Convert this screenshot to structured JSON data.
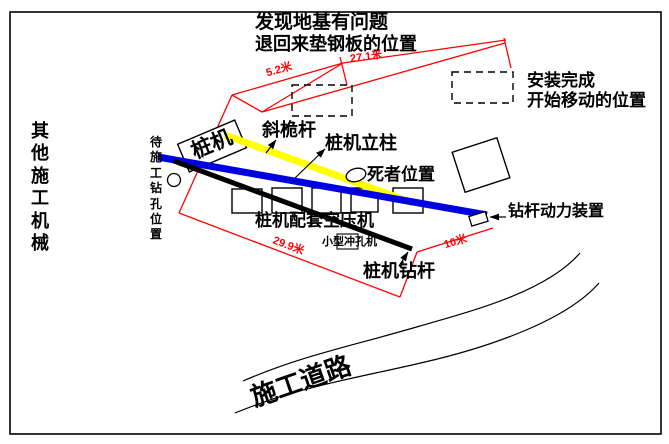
{
  "diagram": {
    "notes": {
      "foundation_issue_line1": "发现地基有问题",
      "foundation_issue_line2": "退回来垫钢板的位置",
      "install_complete_line1": "安装完成",
      "install_complete_line2": "开始移动的位置"
    },
    "labels": {
      "other_machinery": "其他施工机械",
      "pending_borehole": "待施工钻孔位置",
      "pile_machine": "桩机",
      "inclined_mast": "斜桅杆",
      "pile_machine_column": "桩机立柱",
      "victim_position": "死者位置",
      "drill_power_unit": "钻杆动力装置",
      "air_compressor": "桩机配套空压机",
      "small_punching_machine": "小型冲孔机",
      "pile_machine_drill_rod": "桩机钻杆",
      "construction_road": "施工道路"
    },
    "measurements": {
      "seg1": "5.2米",
      "seg2": "27.1米",
      "travel": "29.9米",
      "tail": "10米"
    },
    "colors": {
      "mast": "#ffff00",
      "column": "#0000e0",
      "drill_rod": "#000000",
      "dimension": "#ff0000"
    }
  }
}
